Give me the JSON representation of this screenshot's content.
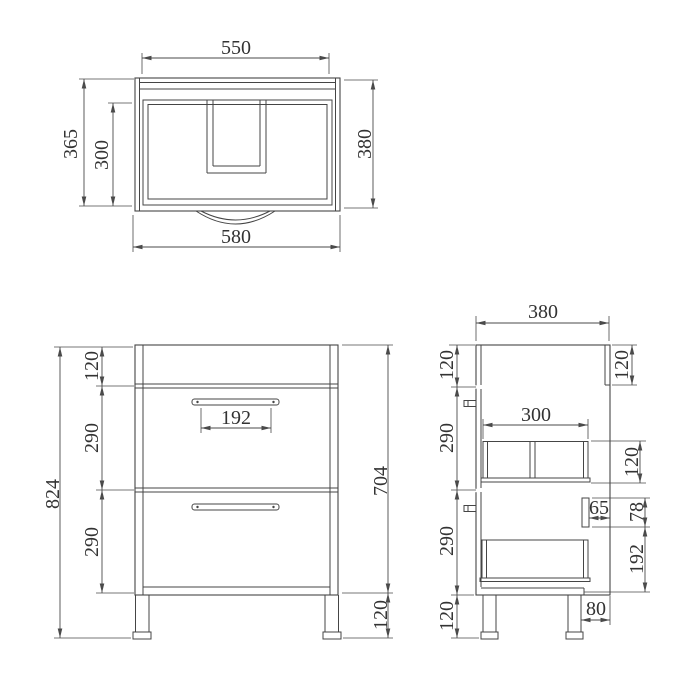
{
  "colors": {
    "line": "#454545",
    "text": "#333333",
    "background": "#ffffff"
  },
  "top_view": {
    "width_inner": "550",
    "width_overall": "580",
    "depth_overall": "365",
    "depth_inner": "300",
    "depth_right": "380"
  },
  "front_view": {
    "height_overall": "824",
    "top_rail": "120",
    "drawer_upper": "290",
    "drawer_lower": "290",
    "handle_width": "192",
    "body_height": "704",
    "leg_height": "120"
  },
  "side_view": {
    "depth_overall": "380",
    "top_left": "120",
    "drawer_upper": "290",
    "drawer_lower": "290",
    "leg_left": "120",
    "back_rail": "120",
    "drawer_depth": "300",
    "drawer_box_height": "120",
    "cutout_gap": "65",
    "cutout_height": "78",
    "cutout_to_bottom": "192",
    "leg_inset": "80"
  }
}
